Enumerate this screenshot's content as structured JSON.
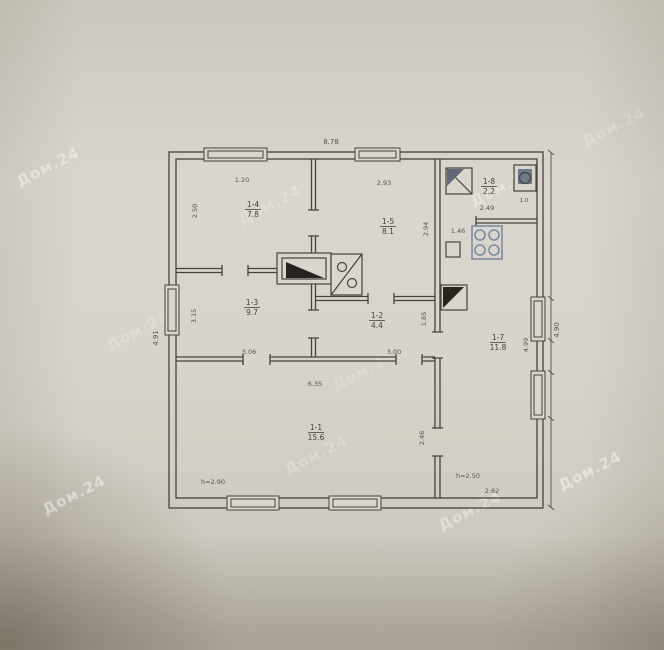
{
  "watermark": {
    "text": "Дом.24"
  },
  "plan": {
    "line_color": "#46423c",
    "accent_blue": "#7e8ba1",
    "outer_dimensions": {
      "top_width": "8.78",
      "left_height": "4.91",
      "right_height": "4.90"
    },
    "rooms": {
      "r14": {
        "number": "1-4",
        "area": "7.8",
        "dim_top": "1.20",
        "dim_left": "2.50"
      },
      "r15": {
        "number": "1-5",
        "area": "8.1",
        "dim_top": "2.93",
        "dim_right": "2.94"
      },
      "r18": {
        "number": "1-8",
        "area": "2.2",
        "dim_bottom": "2.49",
        "fixture_dim": "1.0"
      },
      "r17": {
        "number": "1-7",
        "area": "11.8",
        "dim_right": "4.99",
        "kitchen_dim": "1.46",
        "height_note": "h=2.50",
        "dim_bottom": "2.62"
      },
      "r13": {
        "number": "1-3",
        "area": "9.7",
        "dim_left": "3.15",
        "dim_bottom": "3.06"
      },
      "r12": {
        "number": "1-2",
        "area": "4.4",
        "dim_right": "1.85",
        "dim_bottom": "3.00"
      },
      "r11": {
        "number": "1-1",
        "area": "15.6",
        "dim_top": "6.35",
        "dim_right": "2.46",
        "height_note": "h=2.90"
      }
    }
  }
}
